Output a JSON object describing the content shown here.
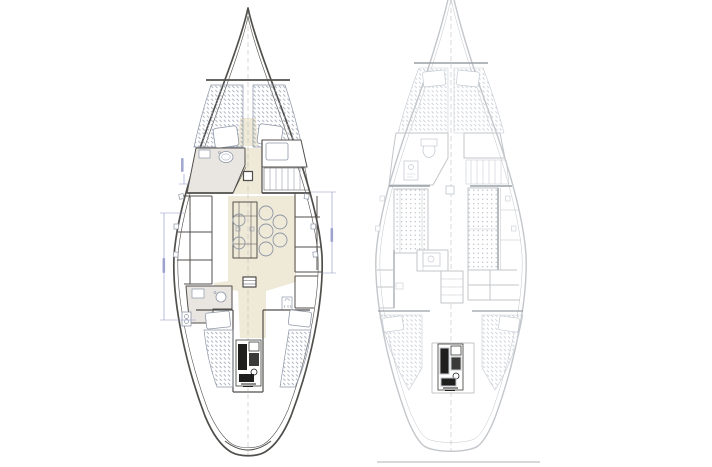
{
  "canvas": {
    "width": 712,
    "height": 467
  },
  "diagram": {
    "kind": "sailboat-interior-arrangement-plans-top-view",
    "plan_count": 2,
    "plans": {
      "left": {
        "name": "arrangement-plan-a",
        "line_style": "dark",
        "has_cream_sole": true,
        "compartments": [
          "bow-anchor-locker",
          "v-berth",
          "head-with-sink",
          "forward-cabin-berth",
          "port-settee",
          "starboard-settee",
          "saloon-folding-table",
          "seat-circles",
          "mast-step",
          "galley-with-sink",
          "stove",
          "companionway-steps",
          "port-aft-berth",
          "starboard-aft-berth",
          "engine-compartment",
          "transom"
        ],
        "dimension_marks": 4,
        "dimension_labels_legible": false
      },
      "right": {
        "name": "arrangement-plan-b",
        "line_style": "light",
        "has_cream_sole": false,
        "bow_cropped_at_top": true,
        "compartments": [
          "v-berth",
          "head-with-toilet",
          "locker-cabinet",
          "starboard-dressing-seat",
          "port-dinette-settee",
          "starboard-double-berth",
          "galley-with-sink",
          "port-lockers",
          "starboard-lockers",
          "companionway-steps",
          "port-aft-berth",
          "starboard-aft-berth",
          "engine-compartment",
          "transom-baseline"
        ]
      }
    }
  },
  "css_vars": {
    "page-bg": "#ffffff",
    "left-stroke": "#514f4c",
    "left-detail": "#8e97a6",
    "sole": "#efe9d8",
    "counter": "#e9e6e2",
    "hatch-left": "#9aa3b3",
    "right-stroke": "#c3c6ca",
    "right-detail": "#c6cbd3",
    "right-dark": "#9aa0a6",
    "dim": "#8d93c6",
    "engine-dark": "#1f1f1d",
    "engine-mid": "#3a3a38",
    "center": "#b9b9b9",
    "baseline": "#b0b0b0"
  }
}
